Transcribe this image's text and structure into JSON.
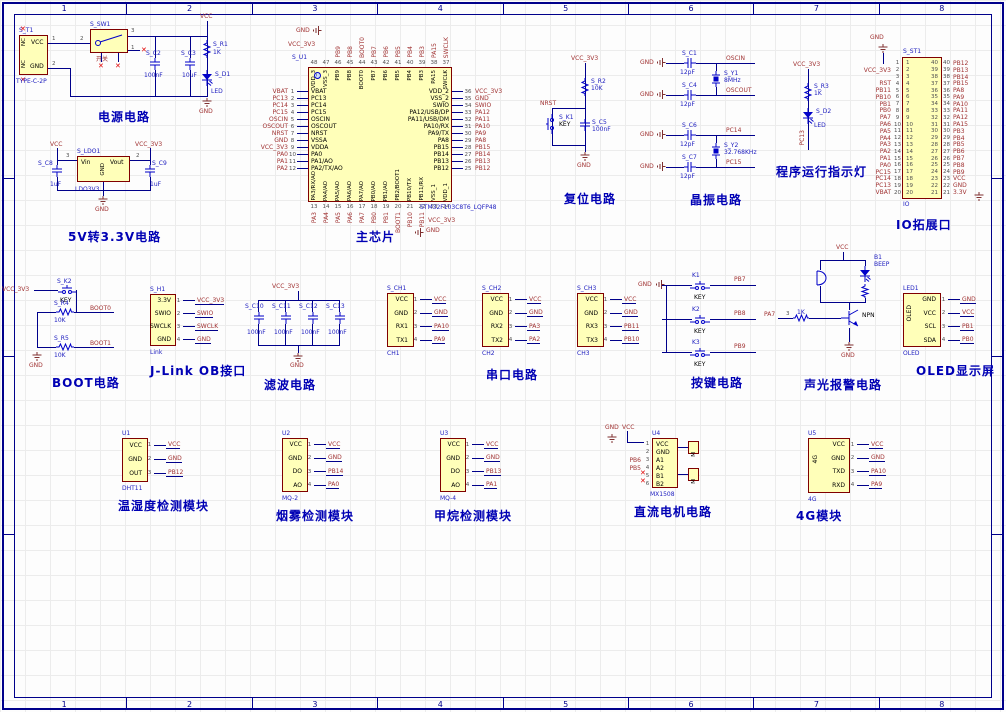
{
  "sheet": {
    "cols": [
      "1",
      "2",
      "3",
      "4",
      "5",
      "6",
      "7",
      "8"
    ]
  },
  "power": {
    "title": "电源电路",
    "vcc": "VCC",
    "gnd": "GND",
    "t1": {
      "des": "S_T1",
      "value": "TYPE-C-2P",
      "pin_vcc": "VCC",
      "pin_gnd": "GND",
      "nc": "NC",
      "n1": "1",
      "n2": "2",
      "n2b": "2"
    },
    "sw": {
      "des": "S_SW1",
      "label": "开关",
      "n3": "3",
      "n1": "1"
    },
    "c2": {
      "des": "S_C2",
      "val": "100nF"
    },
    "c3": {
      "des": "S_C3",
      "val": "10uF"
    },
    "r1": {
      "des": "S_R1",
      "val": "1K"
    },
    "d1": {
      "des": "S_D1",
      "val": "LED"
    }
  },
  "ldo": {
    "title": "5V转3.3V电路",
    "vcc": "VCC",
    "vcc33": "VCC_3V3",
    "gnd": "GND",
    "des": "S_LDO1",
    "value": "LDO3V3",
    "vin": "Vin",
    "vout": "Vout",
    "pgnd": "GND",
    "n3": "3",
    "n2": "2",
    "c8": {
      "des": "S_C8",
      "val": "1uF"
    },
    "c9": {
      "des": "S_C9",
      "val": "1uF"
    }
  },
  "mcu": {
    "title": "主芯片",
    "des": "S_U1",
    "value": "STM32F103C8T6_LQFP48",
    "top_gnd": "GND",
    "top_vcc": "VCC_3V3",
    "bot_vcc": "VCC_3V3",
    "bot_gnd": "GND",
    "left_rows": [
      {
        "net": "VBAT",
        "num": "1",
        "name": "VBAT"
      },
      {
        "net": "PC13",
        "num": "2",
        "name": "PC13"
      },
      {
        "net": "PC14",
        "num": "3",
        "name": "PC14"
      },
      {
        "net": "PC15",
        "num": "4",
        "name": "PC15"
      },
      {
        "net": "OSCIN",
        "num": "5",
        "name": "OSCIN"
      },
      {
        "net": "OSCOUT",
        "num": "6",
        "name": "OSCOUT"
      },
      {
        "net": "NRST",
        "num": "7",
        "name": "NRST"
      },
      {
        "net": "GND",
        "num": "8",
        "name": "VSSA"
      },
      {
        "net": "VCC_3V3",
        "num": "9",
        "name": "VDDA"
      },
      {
        "net": "PA0",
        "num": "10",
        "name": "PA0"
      },
      {
        "net": "PA1",
        "num": "11",
        "name": "PA1/AO"
      },
      {
        "net": "PA2",
        "num": "12",
        "name": "PA2/TX/AO"
      }
    ],
    "right_rows": [
      {
        "name": "VDD_2",
        "num": "36",
        "net": "VCC_3V3"
      },
      {
        "name": "VSS_2",
        "num": "35",
        "net": "GND"
      },
      {
        "name": "SWIO",
        "num": "34",
        "net": "SWIO"
      },
      {
        "name": "PA12/USB/DP",
        "num": "33",
        "net": "PA12"
      },
      {
        "name": "PA11/USB/DM",
        "num": "32",
        "net": "PA11"
      },
      {
        "name": "PA10/RX",
        "num": "31",
        "net": "PA10"
      },
      {
        "name": "PA9/TX",
        "num": "30",
        "net": "PA9"
      },
      {
        "name": "PA8",
        "num": "29",
        "net": "PA8"
      },
      {
        "name": "PB15",
        "num": "28",
        "net": "PB15"
      },
      {
        "name": "PB14",
        "num": "27",
        "net": "PB14"
      },
      {
        "name": "PB13",
        "num": "26",
        "net": "PB13"
      },
      {
        "name": "PB12",
        "num": "25",
        "net": "PB12"
      }
    ],
    "top_names": [
      "VDD_3",
      "VSS_3",
      "PB9",
      "PB8",
      "BOOT0",
      "PB7",
      "PB6",
      "PB5",
      "PB4",
      "PB3",
      "PA15",
      "SWCLK"
    ],
    "top_nums": [
      "48",
      "47",
      "46",
      "45",
      "44",
      "43",
      "42",
      "41",
      "40",
      "39",
      "38",
      "37"
    ],
    "top_nets": [
      "PB9",
      "PB8",
      "BOOT0",
      "PB7",
      "PB6",
      "PB5",
      "PB4",
      "PB3",
      "PA15",
      "SWCLK"
    ],
    "bottom_names": [
      "PA3/RX/AO",
      "PA4/AO",
      "PA5/AO",
      "PA6/AO",
      "PA7/AO",
      "PB0/AO",
      "PB1/AO",
      "PB2/BOOT1",
      "PB10/TX",
      "PB11/RX",
      "VSS_1",
      "VDD_1"
    ],
    "bottom_nums": [
      "13",
      "14",
      "15",
      "16",
      "17",
      "18",
      "19",
      "20",
      "21",
      "22",
      "23",
      "24"
    ],
    "bottom_nets": [
      "PA3",
      "PA4",
      "PA5",
      "PA6",
      "PA7",
      "PB0",
      "PB1",
      "BOOT1",
      "PB10",
      "PB11"
    ]
  },
  "reset": {
    "title": "复位电路",
    "vcc": "VCC_3V3",
    "r_des": "S_R2",
    "r_val": "10K",
    "net": "NRST",
    "k_des": "S_K1",
    "k_val": "KEY",
    "c_des": "S_C5",
    "c_val": "100nF",
    "gnd": "GND"
  },
  "crystal": {
    "title": "晶振电路",
    "rows": [
      {
        "gnd": "GND",
        "des": "S_C1",
        "val": "12pF",
        "net": "OSCIN"
      },
      {
        "gnd": "GND",
        "des": "S_C4",
        "val": "12pF",
        "net": "OSCOUT"
      },
      {
        "gnd": "GND",
        "des": "S_C6",
        "val": "12pF",
        "net": "PC14"
      },
      {
        "gnd": "GND",
        "des": "S_C7",
        "val": "12pF",
        "net": "PC15"
      }
    ],
    "y1_des": "S_Y1",
    "y1_val": "8MHz",
    "y2_des": "S_Y2",
    "y2_val": "32.768KHz"
  },
  "runled": {
    "title": "程序运行指示灯",
    "vcc": "VCC_3V3",
    "r_des": "S_R3",
    "r_val": "1K",
    "d_des": "S_D2",
    "d_val": "LED",
    "net": "PC13"
  },
  "io": {
    "title": "IO拓展口",
    "des": "S_ST1",
    "value": "IO",
    "gnd_top": "GND",
    "rows": [
      {
        "l": "",
        "n": "1",
        "m": "40",
        "r": "PB12"
      },
      {
        "l": "VCC_3V3",
        "n": "2",
        "m": "39",
        "r": "PB13"
      },
      {
        "l": "",
        "n": "3",
        "m": "38",
        "r": "PB14"
      },
      {
        "l": "RST",
        "n": "4",
        "m": "37",
        "r": "PB15"
      },
      {
        "l": "PB11",
        "n": "5",
        "m": "36",
        "r": "PA8"
      },
      {
        "l": "PB10",
        "n": "6",
        "m": "35",
        "r": "PA9"
      },
      {
        "l": "PB1",
        "n": "7",
        "m": "34",
        "r": "PA10"
      },
      {
        "l": "PB0",
        "n": "8",
        "m": "33",
        "r": "PA11"
      },
      {
        "l": "PA7",
        "n": "9",
        "m": "32",
        "r": "PA12"
      },
      {
        "l": "PA6",
        "n": "10",
        "m": "31",
        "r": "PA15"
      },
      {
        "l": "PA5",
        "n": "11",
        "m": "30",
        "r": "PB3"
      },
      {
        "l": "PA4",
        "n": "12",
        "m": "29",
        "r": "PB4"
      },
      {
        "l": "PA3",
        "n": "13",
        "m": "28",
        "r": "PB5"
      },
      {
        "l": "PA2",
        "n": "14",
        "m": "27",
        "r": "PB6"
      },
      {
        "l": "PA1",
        "n": "15",
        "m": "26",
        "r": "PB7"
      },
      {
        "l": "PA0",
        "n": "16",
        "m": "25",
        "r": "PB8"
      },
      {
        "l": "PC15",
        "n": "17",
        "m": "24",
        "r": "PB9"
      },
      {
        "l": "PC14",
        "n": "18",
        "m": "23",
        "r": "VCC"
      },
      {
        "l": "PC13",
        "n": "19",
        "m": "22",
        "r": "GND"
      },
      {
        "l": "VBAT",
        "n": "20",
        "m": "21",
        "r": "3.3V"
      }
    ]
  },
  "boot": {
    "title": "BOOT电路",
    "vcc": "VCC_3V3",
    "k_des": "S_K2",
    "k_val": "KEY",
    "r4_des": "S_R4",
    "r4_val": "10K",
    "net0": "BOOT0",
    "r5_des": "S_R5",
    "r5_val": "10K",
    "net1": "BOOT1",
    "gnd": "GND"
  },
  "jlink": {
    "title": "J-Link OB接口",
    "des": "S_H1",
    "value": "Link",
    "rows": [
      {
        "name": "3.3V",
        "num": "1",
        "net": "VCC_3V3"
      },
      {
        "name": "SWIO",
        "num": "2",
        "net": "SWIO"
      },
      {
        "name": "SWCLK",
        "num": "3",
        "net": "SWCLK"
      },
      {
        "name": "GND",
        "num": "4",
        "net": "GND"
      }
    ]
  },
  "filter": {
    "title": "滤波电路",
    "vcc": "VCC_3V3",
    "gnd": "GND",
    "caps": [
      {
        "des": "S_C10",
        "val": "100nF"
      },
      {
        "des": "S_C11",
        "val": "100nF"
      },
      {
        "des": "S_C12",
        "val": "100nF"
      },
      {
        "des": "S_C13",
        "val": "100nF"
      }
    ]
  },
  "serial": {
    "title": "串口电路",
    "ports": [
      {
        "des": "S_CH1",
        "value": "CH1",
        "rows": [
          {
            "name": "VCC",
            "num": "1",
            "net": "VCC"
          },
          {
            "name": "GND",
            "num": "2",
            "net": "GND"
          },
          {
            "name": "RX1",
            "num": "3",
            "net": "PA10"
          },
          {
            "name": "TX1",
            "num": "4",
            "net": "PA9"
          }
        ]
      },
      {
        "des": "S_CH2",
        "value": "CH2",
        "rows": [
          {
            "name": "VCC",
            "num": "1",
            "net": "VCC"
          },
          {
            "name": "GND",
            "num": "2",
            "net": "GND"
          },
          {
            "name": "RX2",
            "num": "3",
            "net": "PA3"
          },
          {
            "name": "TX2",
            "num": "4",
            "net": "PA2"
          }
        ]
      },
      {
        "des": "S_CH3",
        "value": "CH3",
        "rows": [
          {
            "name": "VCC",
            "num": "1",
            "net": "VCC"
          },
          {
            "name": "GND",
            "num": "2",
            "net": "GND"
          },
          {
            "name": "RX3",
            "num": "3",
            "net": "PB11"
          },
          {
            "name": "TX3",
            "num": "4",
            "net": "PB10"
          }
        ]
      }
    ]
  },
  "keys": {
    "title": "按键电路",
    "gnd": "GND",
    "items": [
      {
        "des": "K1",
        "val": "KEY",
        "net": "PB7"
      },
      {
        "des": "K2",
        "val": "KEY",
        "net": "PB8"
      },
      {
        "des": "K3",
        "val": "KEY",
        "net": "PB9"
      }
    ]
  },
  "alarm": {
    "title": "声光报警电路",
    "vcc": "VCC",
    "b_des": "B1",
    "b_val": "BEEP",
    "pa7": "PA7",
    "r_des": "3",
    "r_val": "1K",
    "npn": "NPN",
    "gnd": "GND"
  },
  "oled": {
    "title": "OLED显示屏",
    "des": "LED1",
    "value": "OLED",
    "inner": "OLED",
    "rows": [
      {
        "name": "GND",
        "num": "1",
        "net": "GND"
      },
      {
        "name": "VCC",
        "num": "2",
        "net": "VCC"
      },
      {
        "name": "SCL",
        "num": "3",
        "net": "PB1"
      },
      {
        "name": "SDA",
        "num": "4",
        "net": "PB0"
      }
    ]
  },
  "mods": [
    {
      "title": "温湿度检测模块",
      "des": "U1",
      "value": "DHT11",
      "rows": [
        {
          "name": "VCC",
          "num": "1",
          "net": "VCC"
        },
        {
          "name": "GND",
          "num": "2",
          "net": "GND"
        },
        {
          "name": "OUT",
          "num": "3",
          "net": "PB12"
        }
      ]
    },
    {
      "title": "烟雾检测模块",
      "des": "U2",
      "value": "MQ-2",
      "rows": [
        {
          "name": "VCC",
          "num": "1",
          "net": "VCC"
        },
        {
          "name": "GND",
          "num": "2",
          "net": "GND"
        },
        {
          "name": "DO",
          "num": "3",
          "net": "PB14"
        },
        {
          "name": "AO",
          "num": "4",
          "net": "PA0"
        }
      ]
    },
    {
      "title": "甲烷检测模块",
      "des": "U3",
      "value": "MQ-4",
      "rows": [
        {
          "name": "VCC",
          "num": "1",
          "net": "VCC"
        },
        {
          "name": "GND",
          "num": "2",
          "net": "GND"
        },
        {
          "name": "DO",
          "num": "3",
          "net": "PB13"
        },
        {
          "name": "AO",
          "num": "4",
          "net": "PA1"
        }
      ]
    }
  ],
  "motor": {
    "title": "直流电机电路",
    "des": "U4",
    "value": "MX1508",
    "gnd": "GND",
    "vcc": "VCC",
    "m": "M",
    "rows": [
      {
        "net": "",
        "num": "1",
        "name": "VCC"
      },
      {
        "net": "",
        "num": "2",
        "name": "GND"
      },
      {
        "net": "PB6",
        "num": "3",
        "name": "A1"
      },
      {
        "net": "PB5",
        "num": "4",
        "name": "A2"
      },
      {
        "net": "",
        "num": "5",
        "name": "B1"
      },
      {
        "net": "",
        "num": "6",
        "name": "B2"
      }
    ]
  },
  "g4": {
    "title": "4G模块",
    "des": "U5",
    "value": "4G",
    "inner": "4G",
    "rows": [
      {
        "name": "VCC",
        "num": "1",
        "net": "VCC"
      },
      {
        "name": "GND",
        "num": "2",
        "net": "GND"
      },
      {
        "name": "TXD",
        "num": "3",
        "net": "PA10"
      },
      {
        "name": "RXD",
        "num": "4",
        "net": "PA9"
      }
    ]
  }
}
